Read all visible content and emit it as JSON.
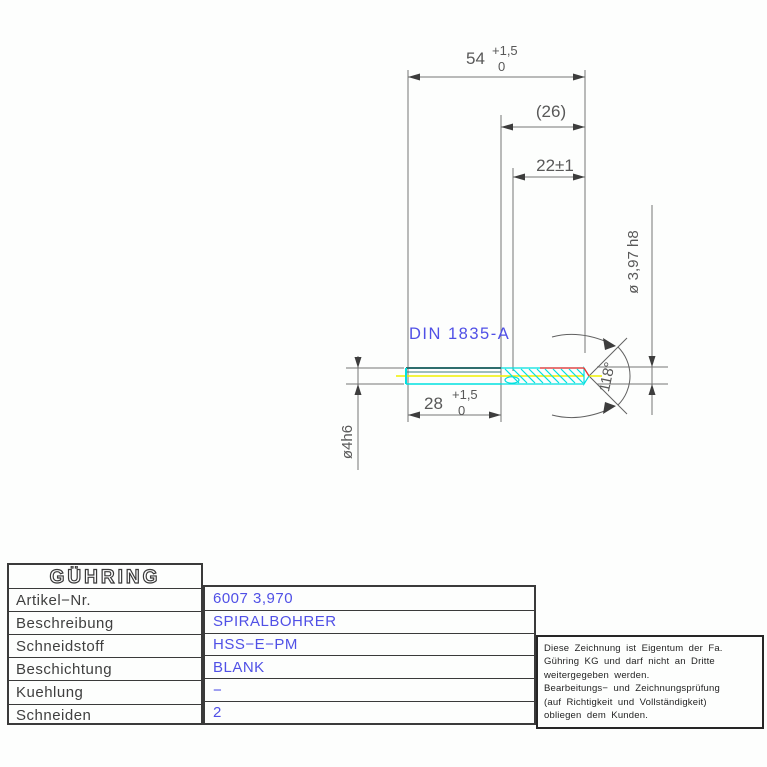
{
  "drawing": {
    "din_label": "DIN 1835-A",
    "dim_overall": {
      "value": "54",
      "tol_upper": "+1,5",
      "tol_lower": "0"
    },
    "dim_flute_ref": "(26)",
    "dim_flute_usable": "22±1",
    "dim_shank_len": {
      "value": "28",
      "tol_upper": "+1,5",
      "tol_lower": "0"
    },
    "dim_shank_dia": "ø4h6",
    "dim_cut_dia": "ø 3,97  h8",
    "dim_point_angle": "118°",
    "colors": {
      "accent_blue": "#5050e6",
      "centerline_yellow": "#f0f000",
      "flute_cyan": "#00e0e0",
      "edge_teal": "#2e6e6e",
      "highlight_red": "#ff2a2a"
    }
  },
  "title_block": {
    "logo_text": "GÜHRING",
    "rows": [
      {
        "label": "Artikel−Nr.",
        "value": "6007 3,970"
      },
      {
        "label": "Beschreibung",
        "value": "SPIRALBOHRER"
      },
      {
        "label": "Schneidstoff",
        "value": "HSS−E−PM"
      },
      {
        "label": "Beschichtung",
        "value": "BLANK"
      },
      {
        "label": "Kuehlung",
        "value": "−"
      },
      {
        "label": "Schneiden",
        "value": "2"
      }
    ]
  },
  "notice": {
    "lines": [
      "Diese Zeichnung ist Eigentum der Fa.",
      "Gühring KG und darf nicht an Dritte",
      "weitergegeben werden.",
      "Bearbeitungs− und Zeichnungsprüfung",
      "(auf Richtigkeit und Vollständigkeit)",
      "obliegen dem Kunden."
    ]
  }
}
